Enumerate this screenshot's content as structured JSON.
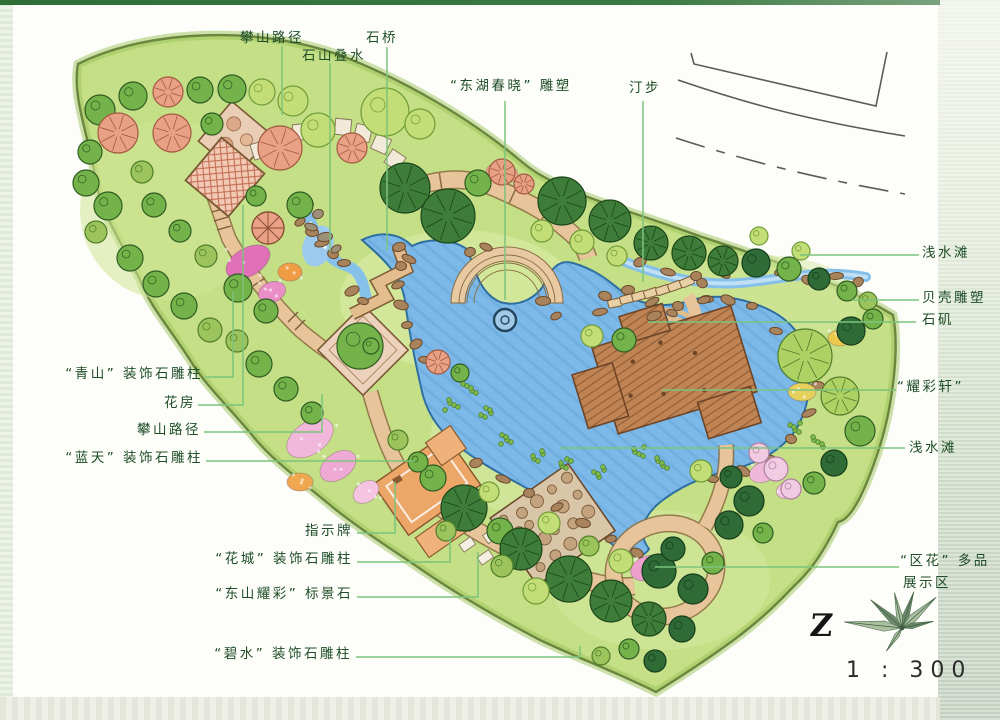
{
  "page": {
    "north_letter": "Z",
    "scale_text": "1 : 300"
  },
  "labels": {
    "panshan_top": "攀山路径",
    "shishan_dieshui": "石山叠水",
    "shiqiao": "石桥",
    "donghu_diaosu": "“东湖春晓” 雕塑",
    "tingbu": "汀步",
    "qianshuitan_1": "浅水滩",
    "beike_diaosu": "贝壳雕塑",
    "shiji": "石矶",
    "yaocaixuan": "“耀彩轩”",
    "qianshuitan_2": "浅水滩",
    "qingshan": "“青山” 装饰石雕柱",
    "huafang": "花房",
    "panshan_left": "攀山路径",
    "lantian": "“蓝天” 装饰石雕柱",
    "zhishipai": "指示牌",
    "huacheng": "“花城” 装饰石雕柱",
    "dongshan": "“东山耀彩” 标景石",
    "bishui": "“碧水” 装饰石雕柱",
    "quhua_1": "“区花” 多品",
    "quhua_2": "展示区"
  },
  "colors": {
    "leader_line": "#7cc47c",
    "label_text": "#1e4d27",
    "pond_blue": "#7db9e8",
    "lawn_green": "#c8e18c",
    "path_tan": "#e7c49a",
    "deck_brown": "#c08454"
  }
}
